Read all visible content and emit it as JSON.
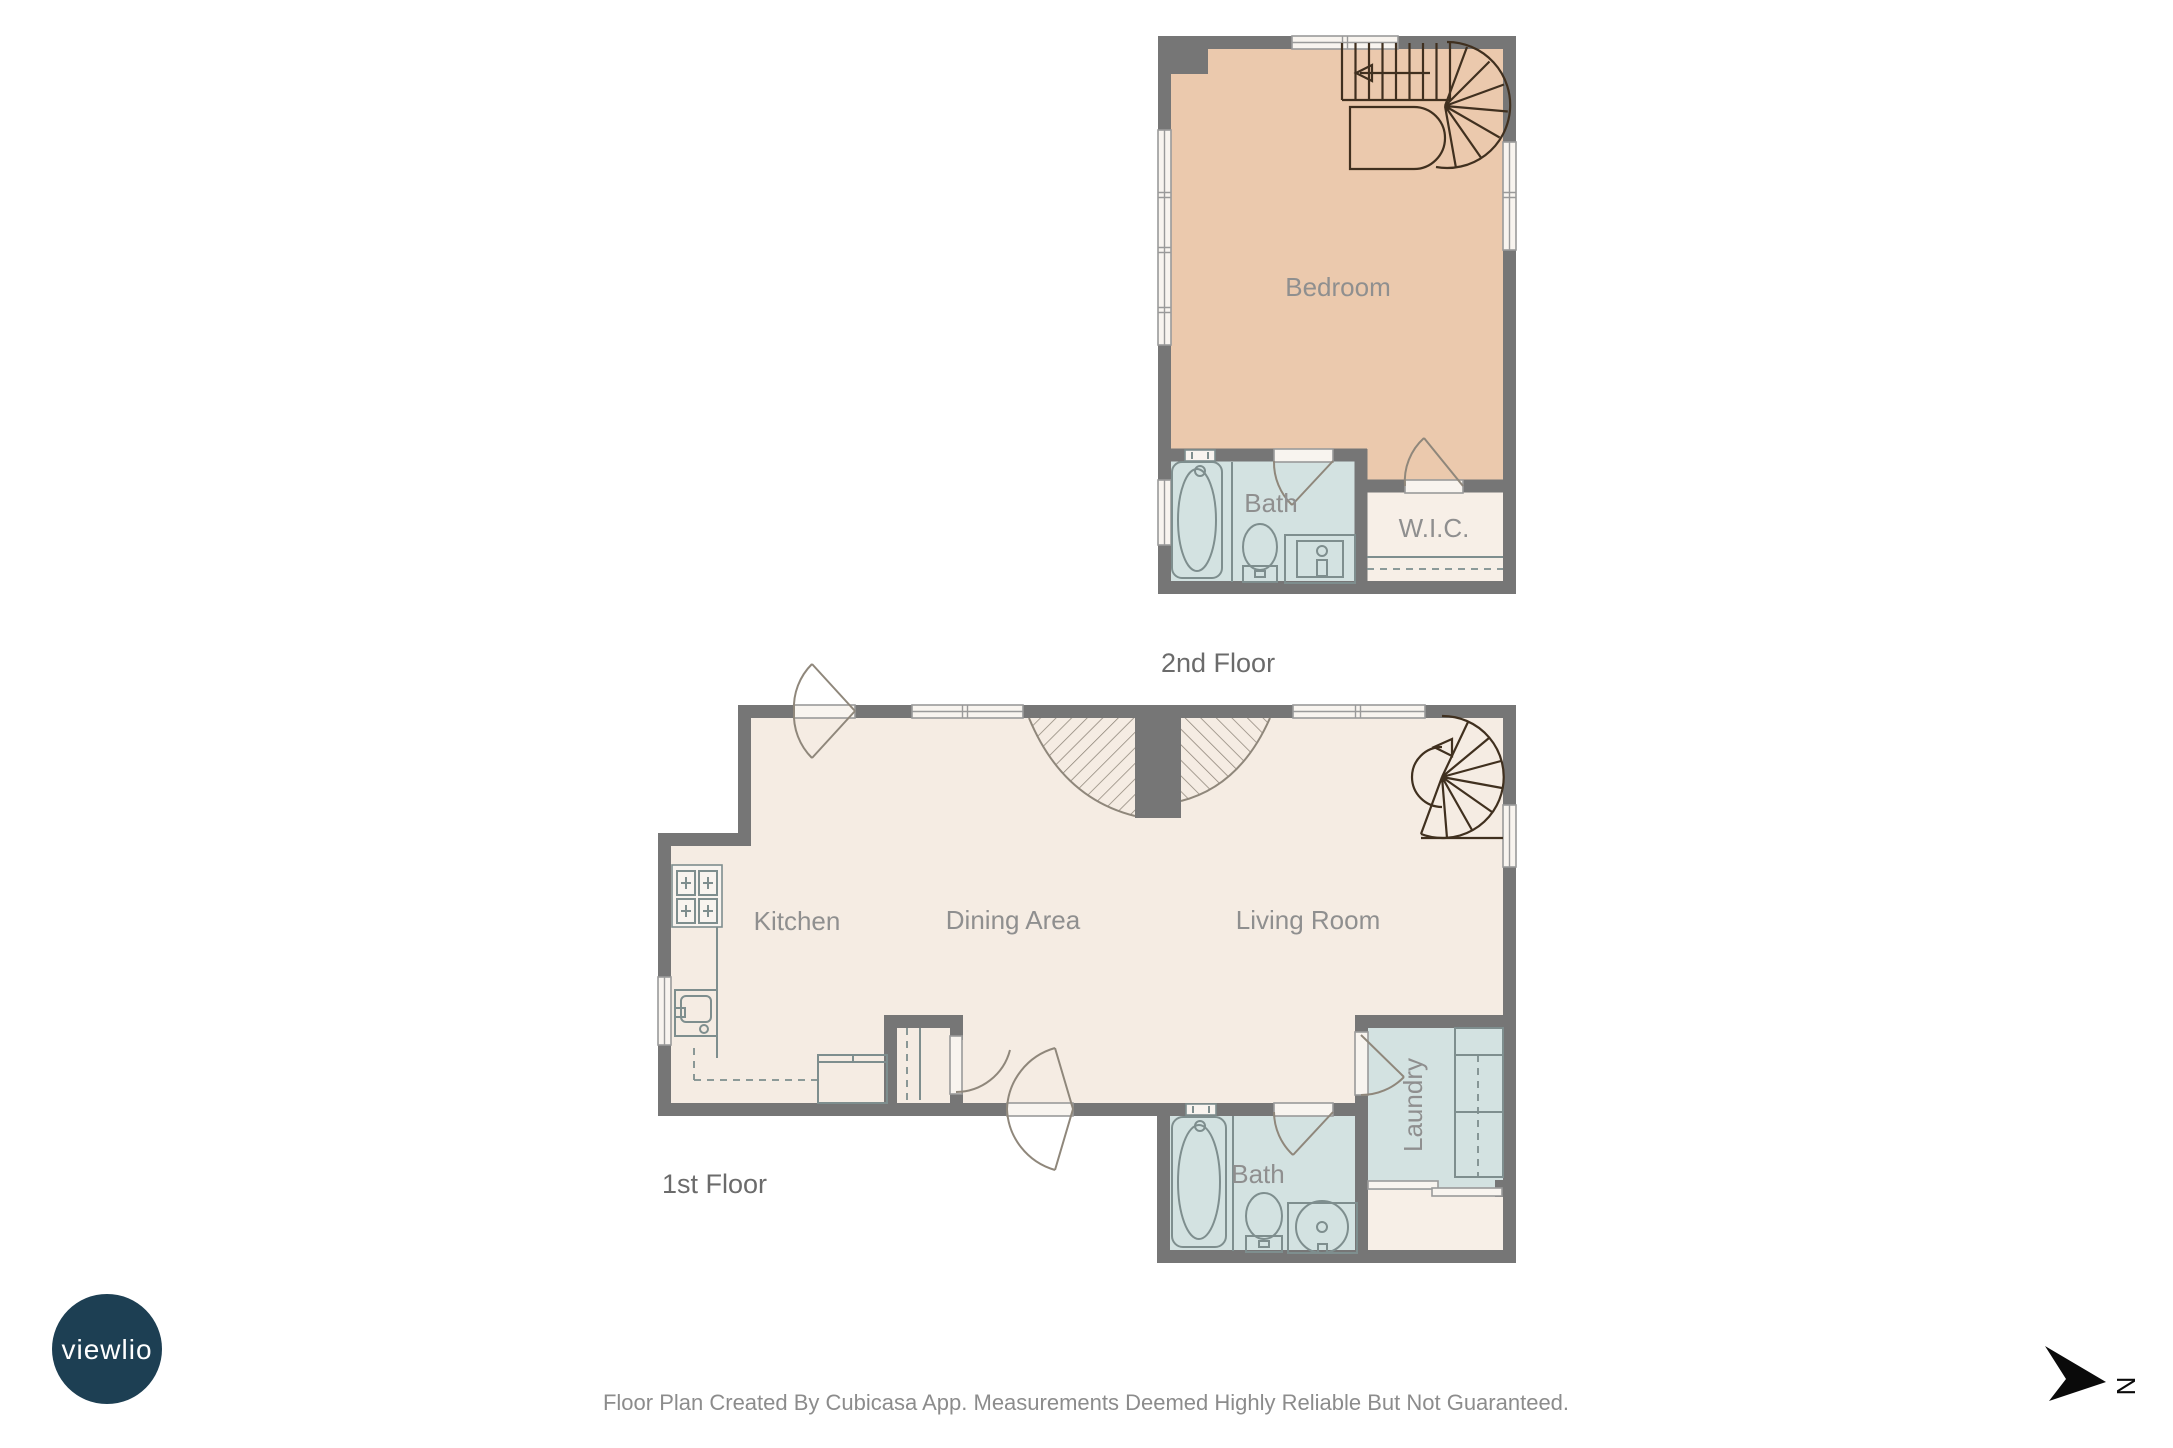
{
  "colors": {
    "wall": "#767676",
    "floor": "#f5ece3",
    "bedroom": "#ebc9ad",
    "wet_room": "#d3e2e1",
    "closet": "#f7efe7",
    "window_fill": "#f8f4ef",
    "window_line": "#9a9a9a",
    "fixture_line": "#7e8e8e",
    "door_arc": "#8f877b",
    "stair_dark": "#40301f",
    "stair_hatch": "#8d8478",
    "room_label": "#8f8f8f",
    "floor_label": "#6b6b6b",
    "footer_text": "#8c8c8c",
    "logo_bg": "#1d3f53",
    "logo_text": "#ffffff",
    "north": "#0a0a0a"
  },
  "second_floor": {
    "label": "2nd Floor",
    "rooms": {
      "bedroom": "Bedroom",
      "bath": "Bath",
      "wic": "W.I.C."
    }
  },
  "first_floor": {
    "label": "1st Floor",
    "rooms": {
      "kitchen": "Kitchen",
      "dining": "Dining Area",
      "living": "Living Room",
      "bath": "Bath",
      "laundry": "Laundry"
    }
  },
  "branding": {
    "logo_text": "viewlio"
  },
  "compass": {
    "north_label": "N",
    "icon": "north-arrow-dart"
  },
  "footer": {
    "disclaimer": "Floor Plan Created By Cubicasa App. Measurements Deemed Highly Reliable But Not Guaranteed."
  }
}
